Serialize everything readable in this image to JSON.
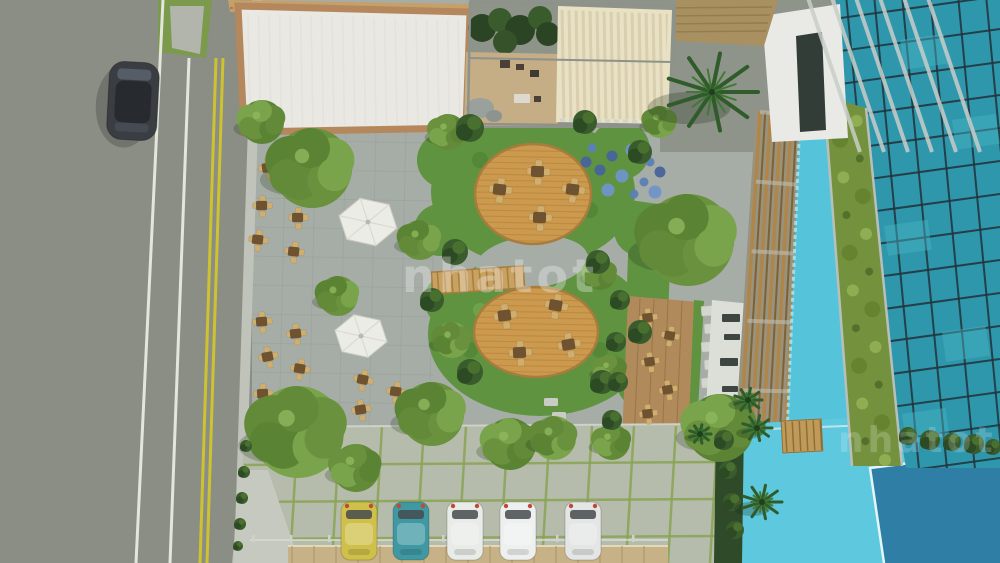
{
  "watermark": {
    "text": "nhatot"
  },
  "scene": {
    "road": {
      "asphalt_color": "#8a8e85",
      "lane_line_color": "#e3e6da",
      "center_line_color": "#cfc231",
      "median_grass_color": "#7c9a4b",
      "moving_car": {
        "x": 133,
        "y": 101,
        "color": "#3a3e43"
      }
    },
    "parking": {
      "paver_color": "#b6bcab",
      "grass_joint_color": "#8aa455",
      "boundary_wall_color": "#c7b186",
      "cars": [
        {
          "name": "yellow-car",
          "color": "#cfc04b",
          "x": 341
        },
        {
          "name": "teal-car",
          "color": "#3f98a2",
          "x": 393
        },
        {
          "name": "white-car-1",
          "color": "#e9ebe9",
          "x": 447
        },
        {
          "name": "white-car-2",
          "color": "#eef0ef",
          "x": 500
        },
        {
          "name": "white-car-3",
          "color": "#e3e6e5",
          "x": 565
        }
      ]
    },
    "garden": {
      "lawn_color": "#5f9340",
      "deck_wood_color": "#cc9a4e",
      "decks": [
        {
          "cx": 533,
          "cy": 194,
          "rx": 58,
          "ry": 50,
          "tables": [
            [
              500,
              190
            ],
            [
              538,
              172
            ],
            [
              573,
              190
            ],
            [
              540,
              218
            ]
          ]
        },
        {
          "cx": 536,
          "cy": 332,
          "rx": 62,
          "ry": 45,
          "tables": [
            [
              505,
              316
            ],
            [
              556,
              306
            ],
            [
              520,
              353
            ],
            [
              569,
              345
            ]
          ]
        }
      ],
      "plaza_tables": [
        [
          268,
          168
        ],
        [
          298,
          180
        ],
        [
          262,
          206
        ],
        [
          298,
          218
        ],
        [
          258,
          240
        ],
        [
          294,
          252
        ],
        [
          262,
          322
        ],
        [
          296,
          334
        ],
        [
          268,
          357
        ],
        [
          300,
          369
        ],
        [
          263,
          394
        ],
        [
          299,
          406
        ],
        [
          363,
          380
        ],
        [
          396,
          392
        ],
        [
          361,
          410
        ]
      ],
      "deck_strip_tables": [
        [
          648,
          318
        ],
        [
          670,
          336
        ],
        [
          650,
          362
        ],
        [
          668,
          390
        ],
        [
          648,
          414
        ]
      ],
      "umbrellas": [
        {
          "cx": 368,
          "cy": 222,
          "r": 30
        },
        {
          "cx": 361,
          "cy": 336,
          "r": 27
        }
      ],
      "trees": [
        [
          312,
          168,
          40
        ],
        [
          262,
          122,
          22
        ],
        [
          298,
          432,
          46
        ],
        [
          356,
          468,
          24
        ],
        [
          432,
          414,
          32
        ],
        [
          510,
          444,
          26
        ],
        [
          554,
          438,
          22
        ],
        [
          612,
          442,
          18
        ],
        [
          688,
          240,
          46
        ],
        [
          720,
          428,
          34
        ],
        [
          660,
          122,
          16
        ],
        [
          448,
          132,
          18
        ],
        [
          420,
          240,
          20
        ],
        [
          600,
          274,
          16
        ],
        [
          452,
          340,
          18
        ],
        [
          610,
          370,
          16
        ],
        [
          338,
          296,
          20
        ]
      ],
      "palms": [
        [
          712,
          92,
          46
        ],
        [
          757,
          428,
          15
        ],
        [
          762,
          502,
          20
        ],
        [
          700,
          434,
          11
        ],
        [
          748,
          400,
          14
        ]
      ],
      "bushes": [
        [
          470,
          128,
          14
        ],
        [
          585,
          122,
          12
        ],
        [
          640,
          152,
          12
        ],
        [
          455,
          252,
          13
        ],
        [
          598,
          262,
          12
        ],
        [
          470,
          372,
          13
        ],
        [
          602,
          382,
          12
        ],
        [
          432,
          300,
          12
        ],
        [
          640,
          332,
          12
        ],
        [
          620,
          300,
          10
        ],
        [
          616,
          342,
          10
        ],
        [
          618,
          382,
          10
        ],
        [
          612,
          420,
          10
        ],
        [
          724,
          440,
          10
        ],
        [
          728,
          470,
          9
        ],
        [
          732,
          502,
          9
        ],
        [
          735,
          530,
          9
        ],
        [
          908,
          436,
          9
        ],
        [
          930,
          440,
          10
        ],
        [
          952,
          442,
          9
        ],
        [
          974,
          444,
          10
        ],
        [
          993,
          447,
          8
        ],
        [
          246,
          446,
          6
        ],
        [
          244,
          472,
          6
        ],
        [
          242,
          498,
          6
        ],
        [
          240,
          524,
          6
        ],
        [
          238,
          546,
          5
        ]
      ],
      "flowers": [
        [
          592,
          148
        ],
        [
          612,
          156
        ],
        [
          632,
          150
        ],
        [
          650,
          162
        ],
        [
          600,
          170
        ],
        [
          622,
          176
        ],
        [
          644,
          182
        ],
        [
          660,
          172
        ],
        [
          608,
          190
        ],
        [
          634,
          194
        ],
        [
          586,
          162
        ],
        [
          655,
          192
        ]
      ]
    },
    "pool": {
      "deck_color": "#5ec9de",
      "deep_color": "#2e7ea6"
    },
    "building": {
      "glass_color": "#2f97ac",
      "mullion_color": "#223239",
      "green_wall_color": "#74923e",
      "roof_color": "#e9e8e3",
      "roof_frame_color": "#b5875c",
      "canopy_color": "#e9e1c4"
    }
  }
}
